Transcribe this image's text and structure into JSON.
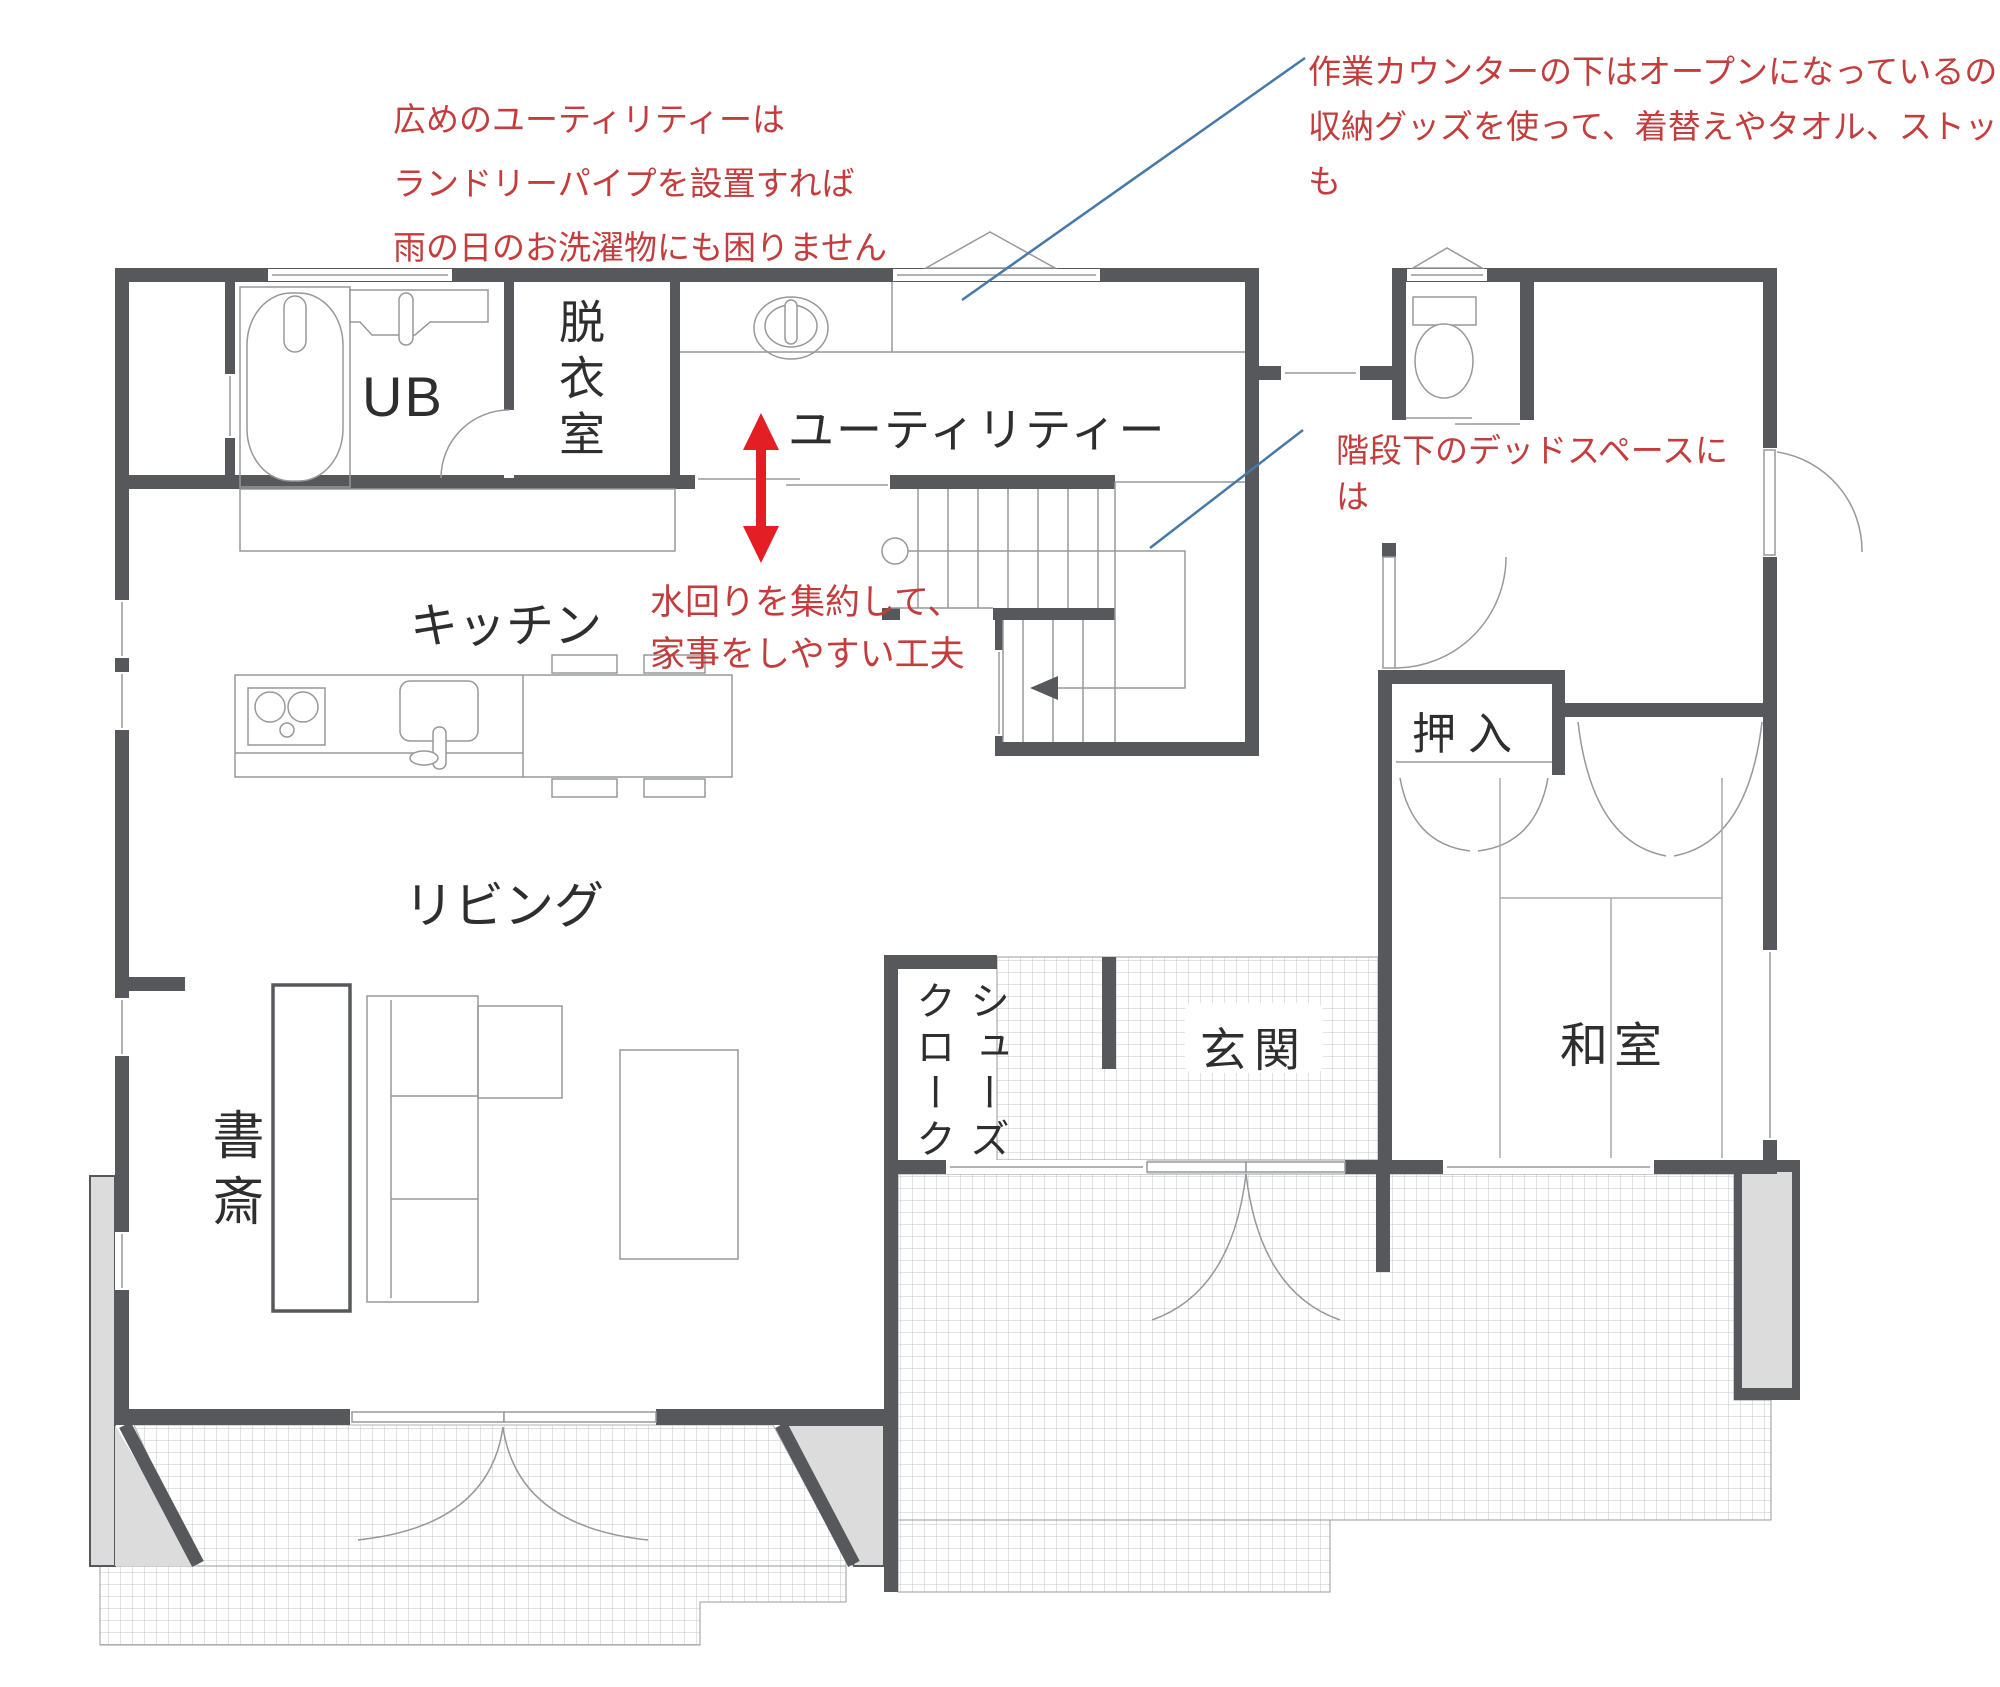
{
  "title": "1F間取り図",
  "rooms": {
    "ub": "UB",
    "datsuishitsu": "脱衣室",
    "utility": "ユーティリティー",
    "kitchen": "キッチン",
    "living": "リビング",
    "shosai": "書斎",
    "shoes_closet_col_right": "シューズ",
    "shoes_closet_col_left": "クローク",
    "genkan": "玄関",
    "oshiire": "押入",
    "washitsu": "和室"
  },
  "annotations": {
    "utility_note": {
      "lines": [
        "広めのユーティリティーは",
        "ランドリーパイプを設置すれば",
        "雨の日のお洗濯物にも困りません"
      ]
    },
    "counter_note": {
      "lines": [
        "作業カウンターの下はオープンになっているので、",
        "収納グッズを使って、着替えやタオル、ストック品",
        "も"
      ]
    },
    "stairs_note": {
      "lines": [
        "階段下のデッドスペースに",
        "は"
      ]
    },
    "mizumawari_note": {
      "lines": [
        "水回りを集約して、",
        "家事をしやすい工夫"
      ]
    }
  },
  "colors": {
    "wall": "#57585c",
    "thin_line": "#97989b",
    "annotation_red": "#c43c3c",
    "arrow_red": "#e41e25",
    "leader_blue": "#4679a8",
    "grid_line": "#c3c5c7",
    "light_fill": "#dcdcdc"
  }
}
